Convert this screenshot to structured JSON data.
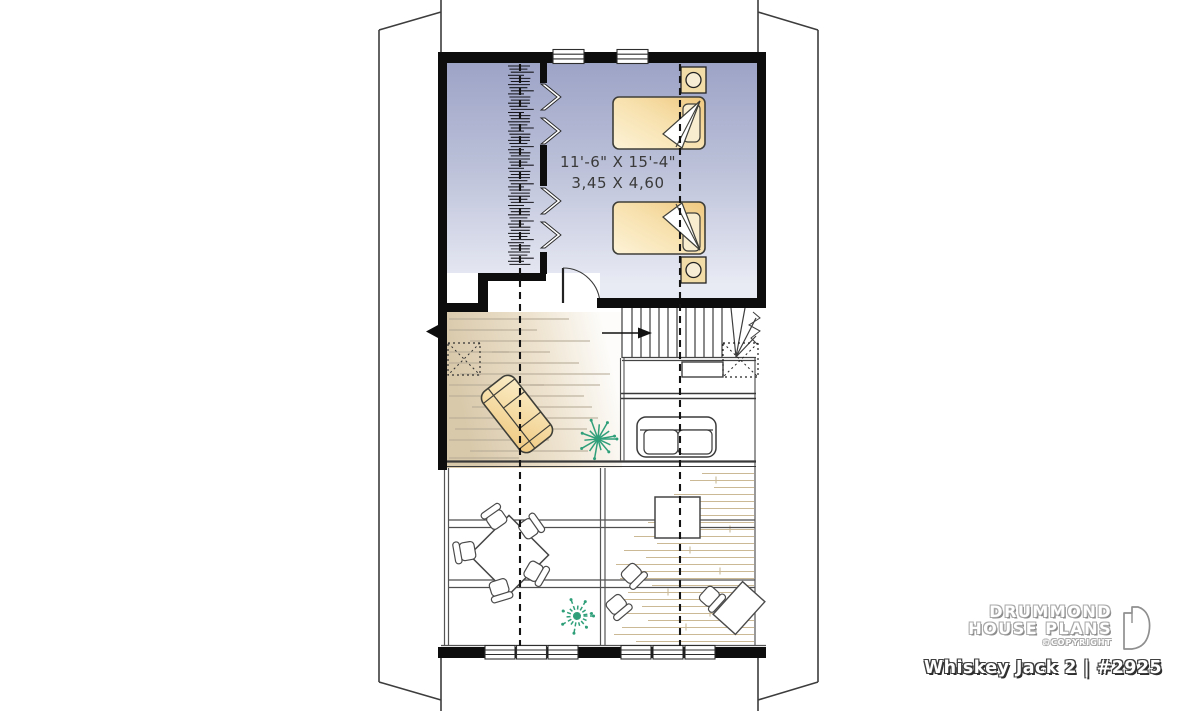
{
  "plan": {
    "title": "Whiskey Jack 2 | #2925",
    "room": {
      "dimensions_imperial": "11'-6\" X 15'-4\"",
      "dimensions_metric": "3,45 X 4,60"
    }
  },
  "branding": {
    "line1": "DRUMMOND",
    "line2": "HOUSE PLANS",
    "copyright_label": "©COPYRIGHT"
  },
  "colors": {
    "wall_black": "#0d0d0d",
    "bedroom_fill_top": "#9ca3c6",
    "bedroom_fill_bottom": "#e9ebf4",
    "furniture_yellow_deep": "#efc87f",
    "furniture_yellow_light": "#fdf3d8",
    "nightstand_tan": "#f2dda8",
    "mezzanine_wood_tan": "#d9c9ab",
    "plank_line_tan": "#cbb996",
    "plant_green": "#2f9f7a",
    "outline_gray": "#3d3d3d"
  }
}
